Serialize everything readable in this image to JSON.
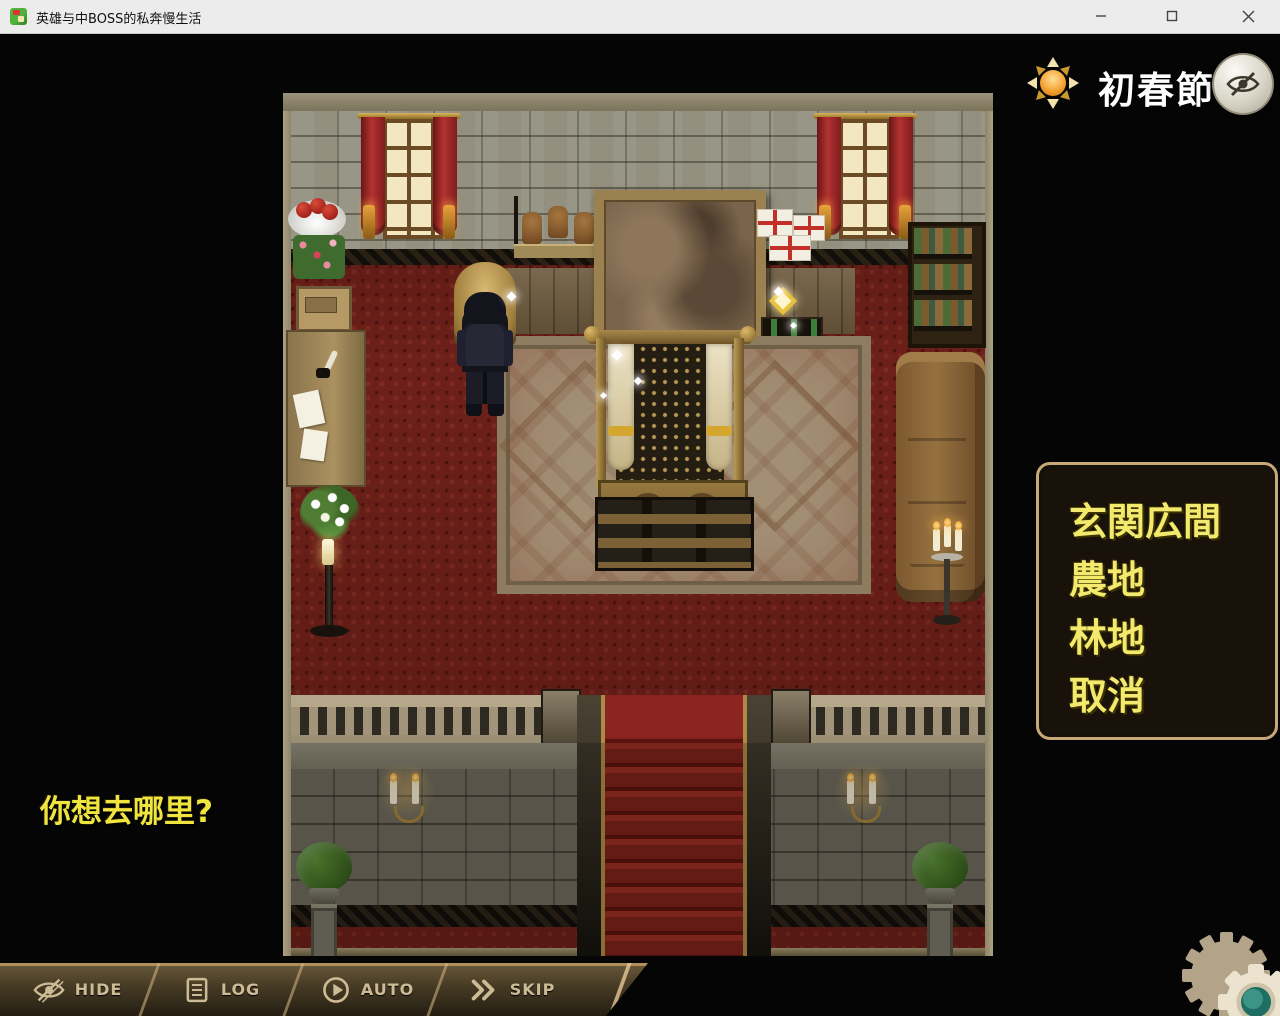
{
  "window": {
    "title": "英雄与中BOSS的私奔慢生活"
  },
  "hud": {
    "season": "初春節"
  },
  "dialogue": {
    "prompt": "你想去哪里?"
  },
  "choices": {
    "items": [
      {
        "label": "玄関広間"
      },
      {
        "label": "農地"
      },
      {
        "label": "林地"
      },
      {
        "label": "取消"
      }
    ]
  },
  "control_bar": {
    "buttons": [
      {
        "label": "HIDE",
        "icon": "eye-off-icon"
      },
      {
        "label": "LOG",
        "icon": "log-icon"
      },
      {
        "label": "AUTO",
        "icon": "auto-play-icon"
      },
      {
        "label": "SKIP",
        "icon": "skip-icon"
      }
    ]
  },
  "colors": {
    "choice_text": "#f2e96d",
    "prompt_text": "#f0e53e",
    "menu_border": "#c9a878",
    "bar_text": "#cdbb96",
    "gear_center": "#2f8a7d",
    "season_text": "#ffffff"
  }
}
